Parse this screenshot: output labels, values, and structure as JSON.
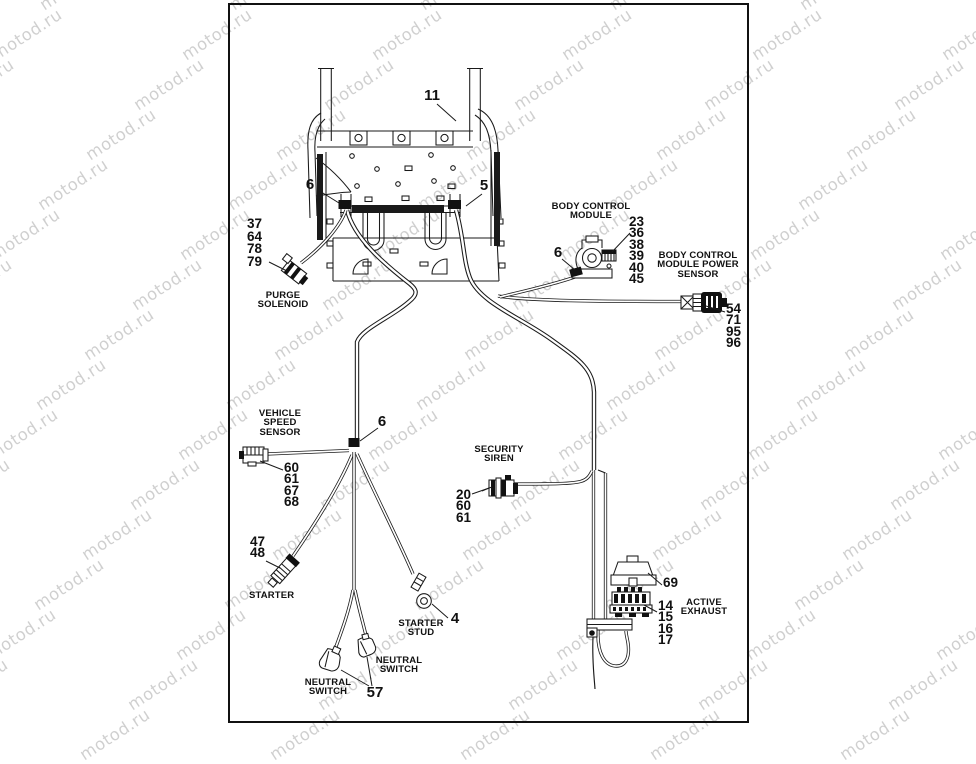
{
  "watermark": {
    "text": "motod.ru"
  },
  "callouts": {
    "frame_top": "11",
    "frame_left_clamp": "6",
    "frame_right_clamp": "5",
    "bcm_clamp": "6",
    "harness_clamp": "6",
    "starter_stud": "4",
    "neutral_switch": "57"
  },
  "components": {
    "purge_solenoid": {
      "label_lines": [
        "PURGE",
        "SOLENOID"
      ],
      "numbers": [
        "37",
        "64",
        "78",
        "79"
      ]
    },
    "body_control_module": {
      "label_lines": [
        "BODY CONTROL",
        "MODULE"
      ],
      "numbers": [
        "23",
        "36",
        "38",
        "39",
        "40",
        "45"
      ]
    },
    "bcm_power_sensor": {
      "label_lines": [
        "BODY CONTROL",
        "MODULE POWER",
        "SENSOR"
      ],
      "numbers": [
        "54",
        "71",
        "95",
        "96"
      ]
    },
    "vehicle_speed_sensor": {
      "label_lines": [
        "VEHICLE",
        "SPEED",
        "SENSOR"
      ],
      "numbers": [
        "60",
        "61",
        "67",
        "68"
      ]
    },
    "security_siren": {
      "label_lines": [
        "SECURITY",
        "SIREN"
      ],
      "numbers": [
        "20",
        "60",
        "61"
      ]
    },
    "starter": {
      "label_lines": [
        "STARTER"
      ],
      "numbers": [
        "47",
        "48"
      ]
    },
    "starter_stud": {
      "label_lines": [
        "STARTER",
        "STUD"
      ]
    },
    "neutral_switch_left": {
      "label_lines": [
        "NEUTRAL",
        "SWITCH"
      ]
    },
    "neutral_switch_right": {
      "label_lines": [
        "NEUTRAL",
        "SWITCH"
      ]
    },
    "active_exhaust": {
      "label_lines": [
        "ACTIVE",
        "EXHAUST"
      ],
      "cap_number": "69",
      "numbers": [
        "14",
        "15",
        "16",
        "17"
      ]
    }
  }
}
